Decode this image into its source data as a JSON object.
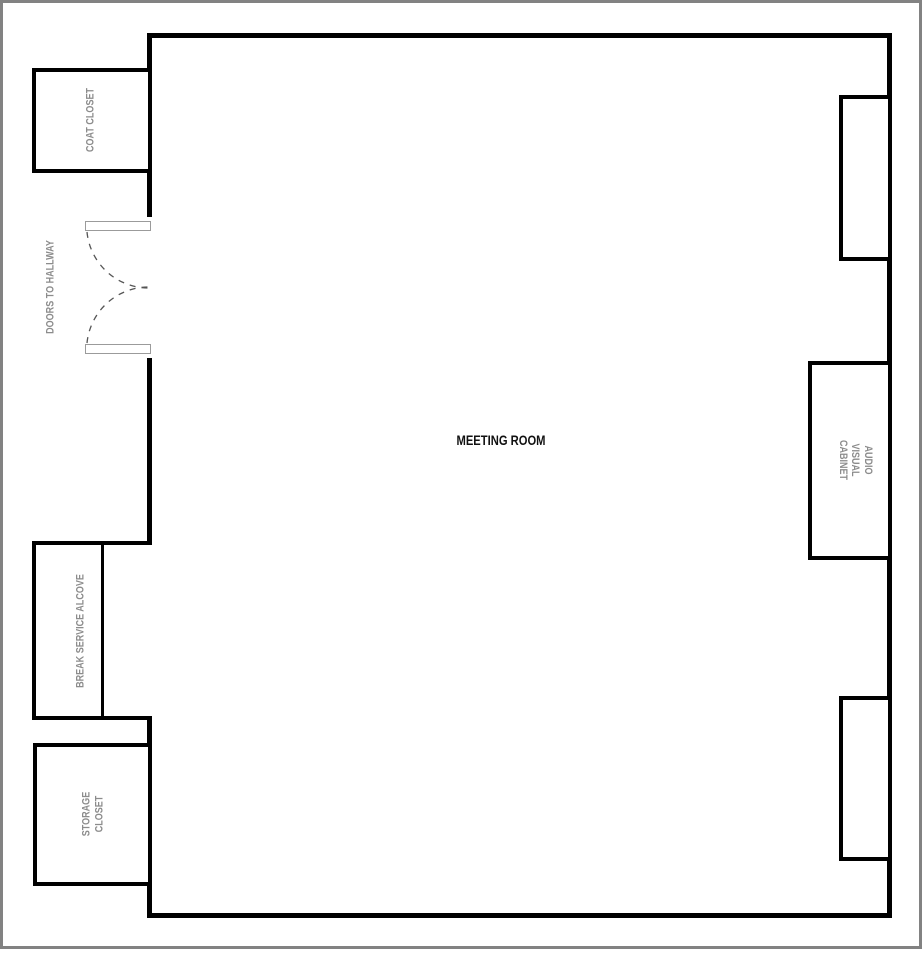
{
  "diagram": {
    "type": "floor-plan"
  },
  "labels": {
    "meeting_room": "MEETING ROOM",
    "coat_closet": "COAT CLOSET",
    "doors_to_hallway": "DOORS TO HALLWAY",
    "break_service_alcove": "BREAK SERVICE ALCOVE",
    "storage_closet": "STORAGE\nCLOSET",
    "audio_visual_cabinet": "AUDIO VISUAL\nCABINET"
  },
  "colors": {
    "wall": "#000000",
    "label_gray": "#8c8c8c",
    "door_outline": "#9b9b9b",
    "door_swing": "#555555",
    "page_border": "#828282",
    "background": "#ffffff"
  }
}
